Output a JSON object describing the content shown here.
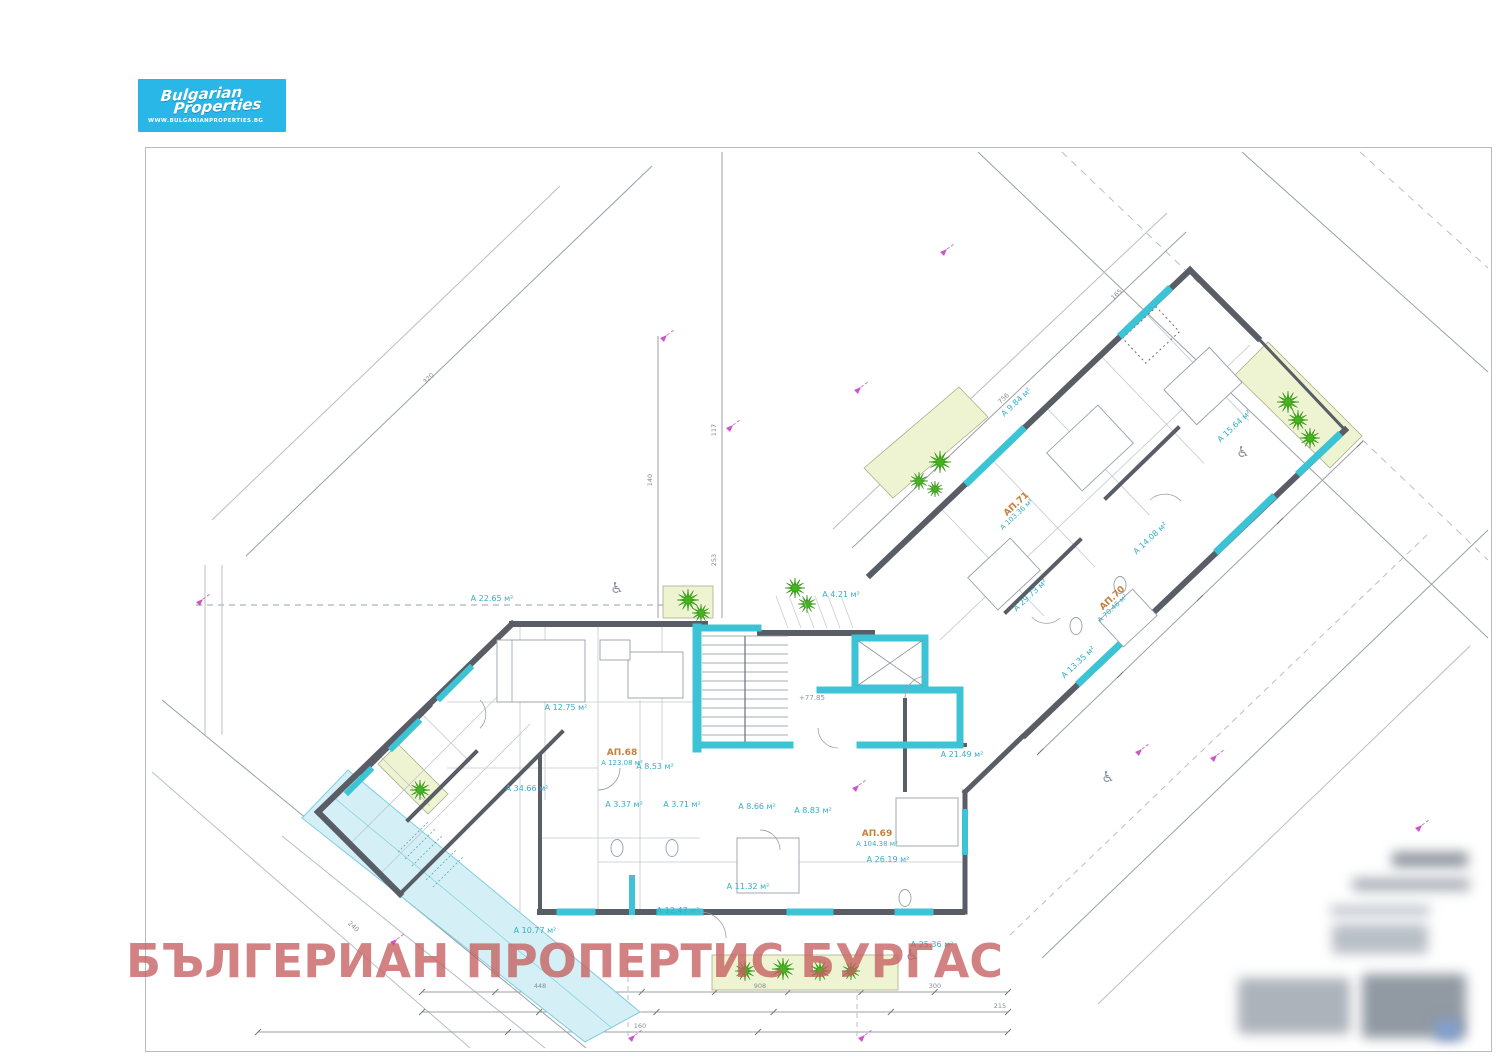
{
  "logo": {
    "brand_line1": "Bulgarian",
    "brand_line2": "Properties",
    "website": "WWW.BULGARIANPROPERTIES.BG"
  },
  "watermark": {
    "text": "БЪЛГЕРИАН ПРОПЕРТИС БУРГАС"
  },
  "colors": {
    "logo_bg": "#29b7e8",
    "watermark": "#c55f5f",
    "wall_dark": "#585d66",
    "accent_cyan": "#3cc4d6",
    "pool_fill": "#d4f0f6",
    "pool_border": "#7fcedd",
    "planter_fill": "#eef4d2",
    "plant_green": "#44b31e",
    "apartment_label": "#c4813b",
    "room_label": "#35aec6",
    "dimension_line": "#9aa0a6",
    "marker_magenta": "#cc55cc"
  },
  "plan": {
    "level_mark": "+77.85",
    "wheelchair_glyph": "♿",
    "apartments": [
      {
        "id": "АП.68",
        "area": "А 123.08 м²",
        "x": 622,
        "y": 755,
        "r": 0
      },
      {
        "id": "АП.69",
        "area": "А 104.38 м²",
        "x": 877,
        "y": 836,
        "r": 0
      },
      {
        "id": "АП.70",
        "area": "А 70.46 м²",
        "x": 1114,
        "y": 600,
        "r": -43
      },
      {
        "id": "АП.71",
        "area": "А 103.36 м²",
        "x": 1018,
        "y": 506,
        "r": -43
      }
    ],
    "rooms": [
      {
        "t": "А 22.65 м²",
        "x": 492,
        "y": 601,
        "r": 0
      },
      {
        "t": "А 12.75 м²",
        "x": 566,
        "y": 710,
        "r": 0
      },
      {
        "t": "А 34.66 м²",
        "x": 527,
        "y": 791,
        "r": 0
      },
      {
        "t": "А 10.77 м²",
        "x": 535,
        "y": 933,
        "r": 0
      },
      {
        "t": "А 3.37 м²",
        "x": 624,
        "y": 807,
        "r": 0
      },
      {
        "t": "А 3.71 м²",
        "x": 682,
        "y": 807,
        "r": 0
      },
      {
        "t": "А 8.53 м²",
        "x": 655,
        "y": 769,
        "r": 0
      },
      {
        "t": "А 8.66 м²",
        "x": 757,
        "y": 809,
        "r": 0
      },
      {
        "t": "А 8.83 м²",
        "x": 813,
        "y": 813,
        "r": 0
      },
      {
        "t": "А 21.49 м²",
        "x": 962,
        "y": 757,
        "r": 0
      },
      {
        "t": "А 12.47 м²",
        "x": 678,
        "y": 913,
        "r": 0
      },
      {
        "t": "А 11.32 м²",
        "x": 748,
        "y": 889,
        "r": 0
      },
      {
        "t": "А 26.19 м²",
        "x": 888,
        "y": 862,
        "r": 0
      },
      {
        "t": "А 25.36 м²",
        "x": 932,
        "y": 947,
        "r": 0
      },
      {
        "t": "А 4.21 м²",
        "x": 841,
        "y": 597,
        "r": 0
      },
      {
        "t": "А 13.35 м²",
        "x": 1080,
        "y": 664,
        "r": -43
      },
      {
        "t": "А 29.73 м²",
        "x": 1032,
        "y": 597,
        "r": -43
      },
      {
        "t": "А 9.84 м²",
        "x": 1018,
        "y": 404,
        "r": -43
      },
      {
        "t": "А 15.64 м²",
        "x": 1236,
        "y": 428,
        "r": -43
      },
      {
        "t": "А 14.08 м²",
        "x": 1152,
        "y": 540,
        "r": -43
      }
    ],
    "dims": [
      {
        "t": "448",
        "x": 540,
        "y": 988,
        "r": 0
      },
      {
        "t": "908",
        "x": 760,
        "y": 988,
        "r": 0
      },
      {
        "t": "300",
        "x": 935,
        "y": 988,
        "r": 0
      },
      {
        "t": "215",
        "x": 1000,
        "y": 1008,
        "r": 0
      },
      {
        "t": "160",
        "x": 640,
        "y": 1028,
        "r": 0
      },
      {
        "t": "117",
        "x": 716,
        "y": 430,
        "r": -90
      },
      {
        "t": "253",
        "x": 716,
        "y": 560,
        "r": -90
      },
      {
        "t": "140",
        "x": 652,
        "y": 480,
        "r": -90
      },
      {
        "t": "756",
        "x": 1005,
        "y": 400,
        "r": -43
      },
      {
        "t": "165",
        "x": 1118,
        "y": 296,
        "r": -43
      },
      {
        "t": "320",
        "x": 430,
        "y": 380,
        "r": -44
      },
      {
        "t": "240",
        "x": 352,
        "y": 928,
        "r": 42
      }
    ]
  }
}
